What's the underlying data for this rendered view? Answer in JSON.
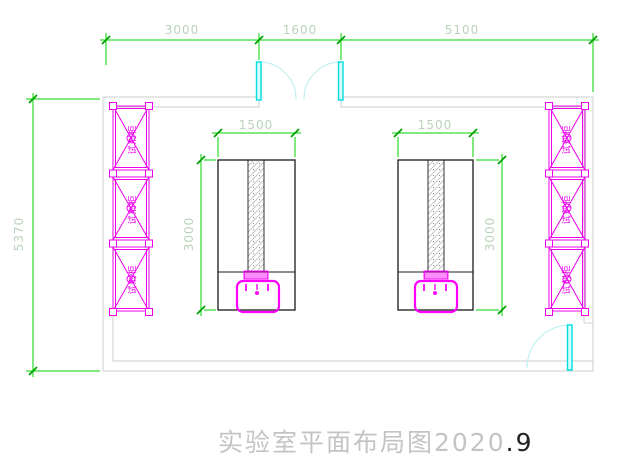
{
  "title": {
    "main": "实验室平面布局图2020",
    "suffix": ".9"
  },
  "dimensions": {
    "top": [
      {
        "label": "3000"
      },
      {
        "label": "1600"
      },
      {
        "label": "5100"
      }
    ],
    "left_height": "5370"
  },
  "benches": [
    {
      "name": "left-bench",
      "width_label": "1500",
      "depth_label": "3000"
    },
    {
      "name": "right-bench",
      "width_label": "1500",
      "depth_label": "3000"
    }
  ],
  "cabinets": {
    "left_labels": [
      "试剂柜",
      "试剂柜",
      "试剂柜"
    ],
    "right_labels": [
      "试剂柜",
      "试剂柜",
      "试剂柜"
    ]
  },
  "colors": {
    "dimension_line": "#00d400",
    "dimension_tick": "#00a000",
    "dimension_text": "#b9d2b9",
    "cabinet": "#ee00ee",
    "sink": "#ff00ff",
    "door_panel": "#00dede",
    "door_arc": "#b4f0ee",
    "wall": "#cccccc",
    "bench_outline": "#1a1a1a",
    "title_gray": "#c4c4c4"
  }
}
